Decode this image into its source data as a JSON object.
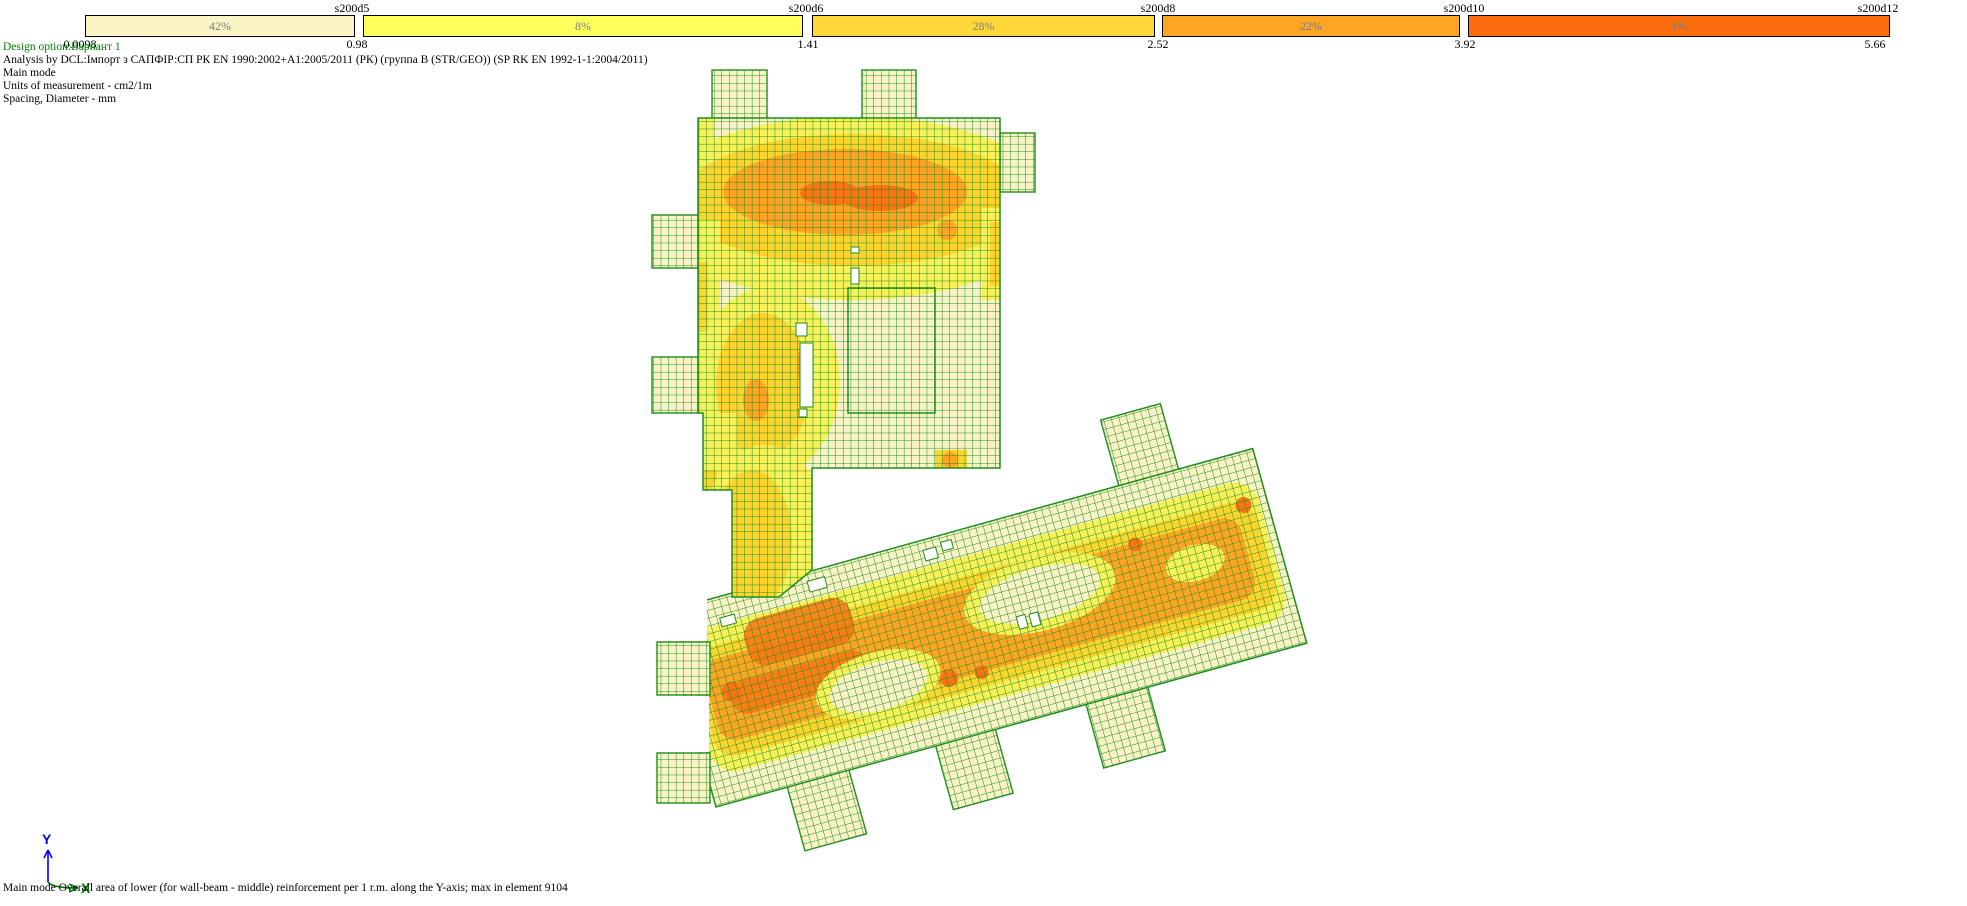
{
  "scale": {
    "percent_text_color": "#70808F",
    "ticks": [
      "0.0098",
      "0.98",
      "1.41",
      "2.52",
      "3.92",
      "5.66"
    ],
    "segments": [
      {
        "name": "s200d5",
        "percent": "42%",
        "color": "#FAF3C3"
      },
      {
        "name": "s200d6",
        "percent": "8%",
        "color": "#FFFF5C"
      },
      {
        "name": "s200d8",
        "percent": "28%",
        "color": "#FFD739"
      },
      {
        "name": "s200d10",
        "percent": "22%",
        "color": "#FFA524"
      },
      {
        "name": "s200d12",
        "percent": "1%",
        "color": "#FB6D0E"
      }
    ]
  },
  "info": {
    "design_option": "Design option:Вариант 1",
    "design_option_color": "#008000",
    "analysis": "Analysis by DCL:Імпорт з САПФІР:СП РК EN 1990:2002+A1:2005/2011 (РК) (группа B (STR/GEO)) (SP RK EN 1992-1-1:2004/2011)",
    "mode": "Main mode",
    "units": "Units of measurement - cm2/1m",
    "spacing": "Spacing, Diameter - mm"
  },
  "status_line": "Main mode Overall area of lower (for wall-beam - middle) reinforcement per 1 r.m. along the Y-axis; max in element 9104",
  "axis_triad": {
    "y_label": "Y",
    "y_color": "#0000FF",
    "x_label": "X",
    "x_color": "#008000"
  },
  "palette": {
    "cream": "#F9F2C6",
    "yellow": "#F8F058",
    "gold": "#FFD42E",
    "orange": "#FFA423",
    "deep_orange": "#FA7412",
    "mesh_line": "#1E8E1E"
  }
}
